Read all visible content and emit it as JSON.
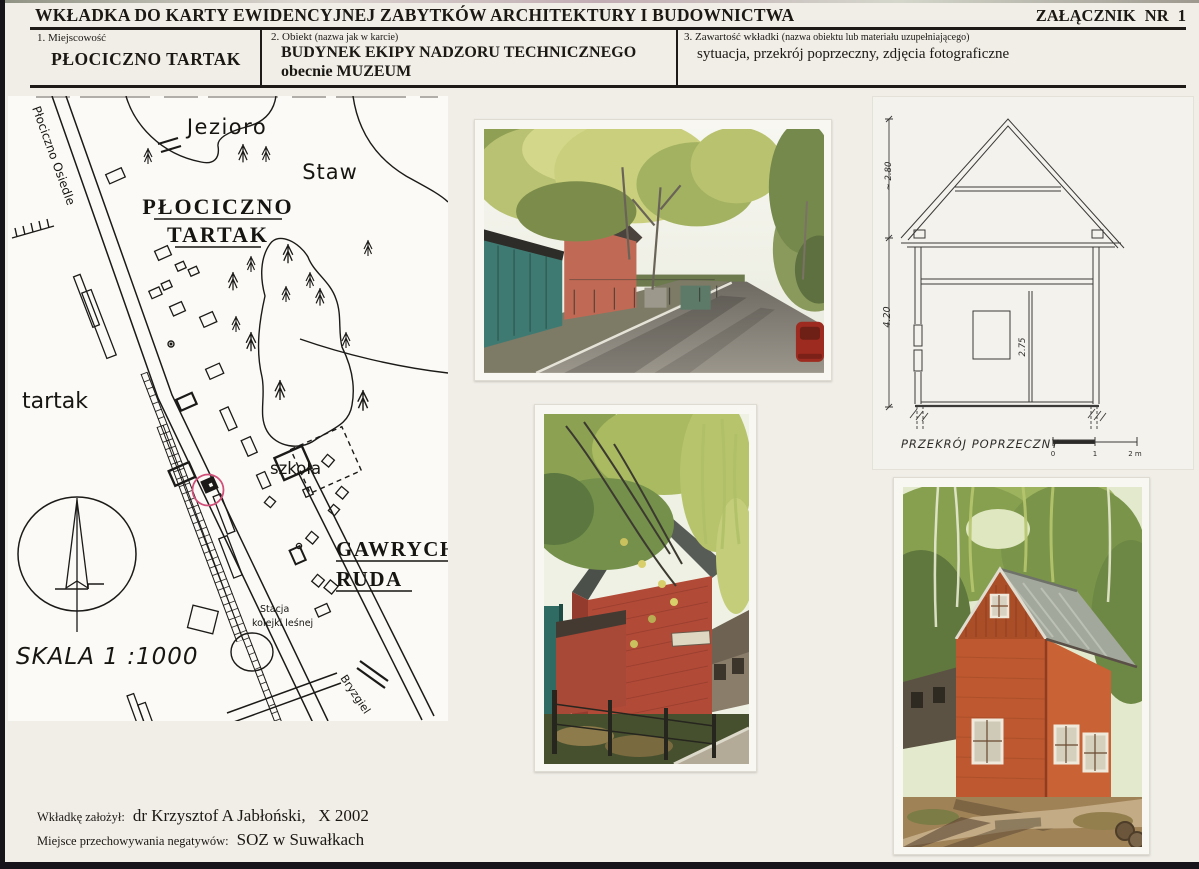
{
  "page": {
    "title": "WKŁADKA DO KARTY EWIDENCYJNEJ ZABYTKÓW ARCHITEKTURY I BUDOWNICTWA",
    "attachment": "ZAŁĄCZNIK  NR  1"
  },
  "fields": {
    "f1_label": "1. Miejscowość",
    "f1_value": "PŁOCICZNO  TARTAK",
    "f2_label": "2. Obiekt",
    "f2_note": "(nazwa jak w karcie)",
    "f2_value1": "BUDYNEK EKIPY NADZORU TECHNICZNEGO",
    "f2_value2": "obecnie  MUZEUM",
    "f3_label": "3. Zawartość wkładki",
    "f3_note": "(nazwa obiektu lub materiału uzupełniającego)",
    "f3_value": "sytuacja, przekrój poprzeczny, zdjęcia fotograficzne"
  },
  "map": {
    "jezioro": "Jezioro",
    "staw": "Staw",
    "plociczno": "PŁOCICZNO",
    "tartak_caps": "TARTAK",
    "tartak_small": "tartak",
    "szkola": "szkoła",
    "gawrych": "GAWRYCH",
    "ruda": "RUDA",
    "stacja1": "Stacja",
    "stacja2": "kolejki leśnej",
    "road_label_1": "Płociczno Osiedle",
    "road_label_2": "Bryzgiel",
    "skala": "SKALA  1 :1000",
    "marker_color": "#d0507a"
  },
  "section": {
    "caption": "PRZEKRÓJ  POPRZECZNY",
    "dim_roof": "~ 2.80",
    "dim_height": "4.20",
    "dim_inner": "2.75",
    "tick0": "0",
    "tick1": "1",
    "tick2": "2 m"
  },
  "footer": {
    "l1_label": "Wkładkę założył:",
    "l1_value": "dr Krzysztof A Jabłoński,   X 2002",
    "l2_label": "Miejsce przechowywania negatywów:",
    "l2_value": "SOZ w Suwałkach"
  }
}
